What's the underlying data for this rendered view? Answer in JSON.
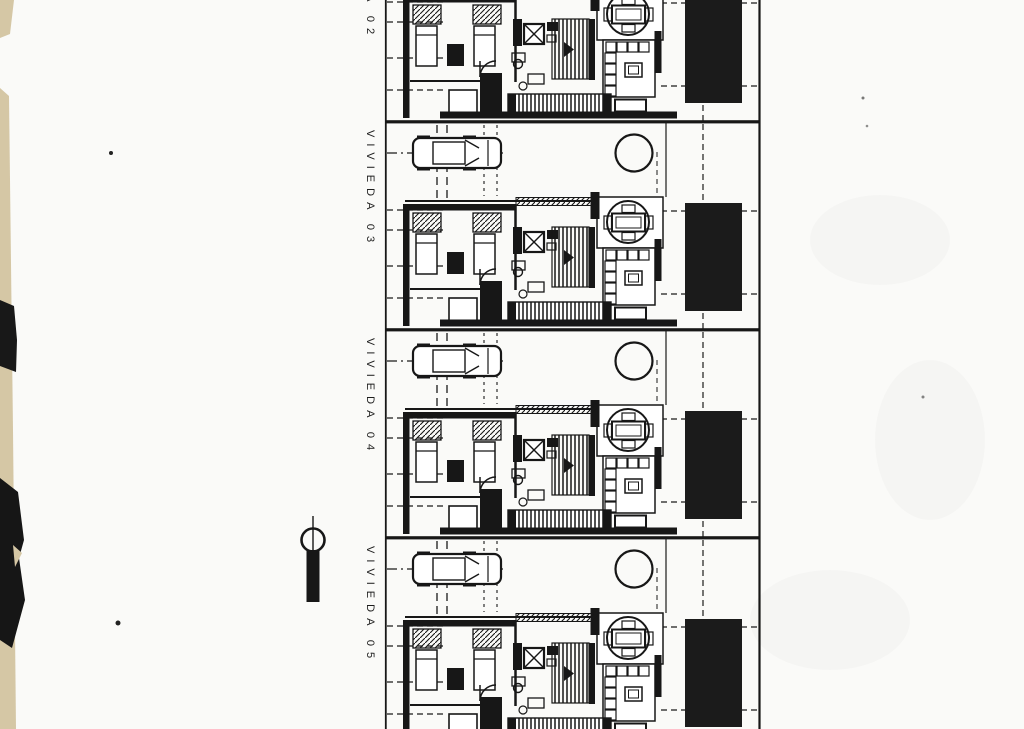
{
  "page": {
    "background": "#fafaf8",
    "ink_color": "#171717",
    "paper_edge_color": "#d5c7a5",
    "pool_color": "#1b1b1b"
  },
  "drawing": {
    "type": "scanned architectural site plan, row of identical dwelling units",
    "units": [
      {
        "id": "vivieda-02",
        "label": "VIVIEDA 02"
      },
      {
        "id": "vivieda-03",
        "label": "VIVIEDA 03"
      },
      {
        "id": "vivieda-04",
        "label": "VIVIEDA 04"
      },
      {
        "id": "vivieda-05",
        "label": "VIVIEDA 05"
      }
    ],
    "symbols": [
      "car-top-view-icon",
      "tree-icon",
      "dining-table-icon",
      "sofa-icon",
      "bed-icon",
      "closet-hatch-icon",
      "shower-icon",
      "stairs-icon",
      "door-swing-icon",
      "pool-rect",
      "survey-marker-icon"
    ]
  }
}
